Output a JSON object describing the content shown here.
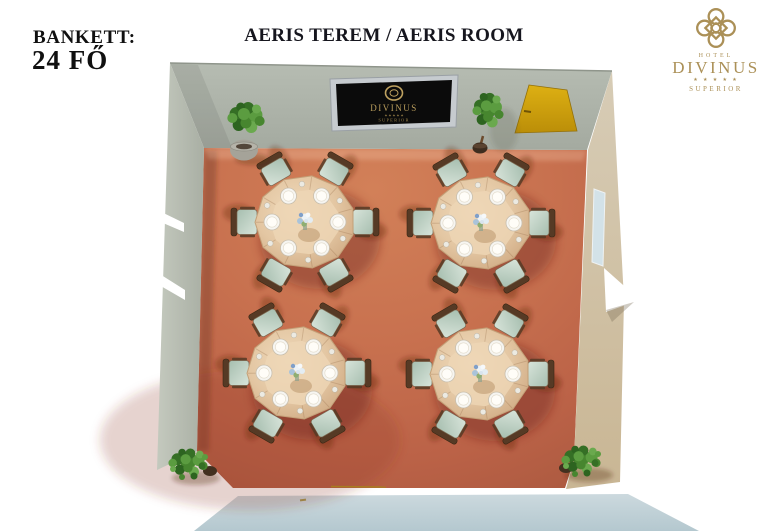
{
  "header": {
    "capacity_label": "BANKETT:",
    "capacity_value": "24 FŐ",
    "title": "AERIS TEREM / AERIS ROOM"
  },
  "brand": {
    "hotel_label": "HOTEL",
    "name": "DIVINUS",
    "stars": "★ ★ ★ ★ ★",
    "tier": "SUPERIOR",
    "gold": "#ab9057"
  },
  "room": {
    "screen": {
      "brand": "DIVINUS",
      "stars": "★ ★ ★ ★ ★",
      "tier": "SUPERIOR"
    },
    "layout": {
      "tables": [
        {
          "id": 1,
          "x": 305,
          "y": 222
        },
        {
          "id": 2,
          "x": 481,
          "y": 223
        },
        {
          "id": 3,
          "x": 297,
          "y": 373
        },
        {
          "id": 4,
          "x": 480,
          "y": 374
        }
      ],
      "seats_per_table": 6,
      "total_seats": 24,
      "plants": [
        {
          "type": "potted-plant",
          "x": 244,
          "y": 150
        },
        {
          "type": "ficus-tree",
          "x": 488,
          "y": 112
        },
        {
          "type": "bush",
          "x": 188,
          "y": 464
        },
        {
          "type": "bush",
          "x": 581,
          "y": 461
        }
      ]
    },
    "colors": {
      "floor": "#c8714f",
      "wall": "#aeb4aa",
      "wall_right": "#cfc0a4",
      "door": "#d3a20e",
      "front_face": "#c2d2d8",
      "window": "#d3e2e8",
      "tablecloth": "#e3c6a2",
      "chair_seat": "#bdd2c6",
      "chair_wood": "#563a25",
      "plant_green": "#47862f",
      "screen_bg": "#0b0b0b",
      "screen_frame": "#c6cbcf",
      "screen_gold": "#b99d5c"
    }
  }
}
